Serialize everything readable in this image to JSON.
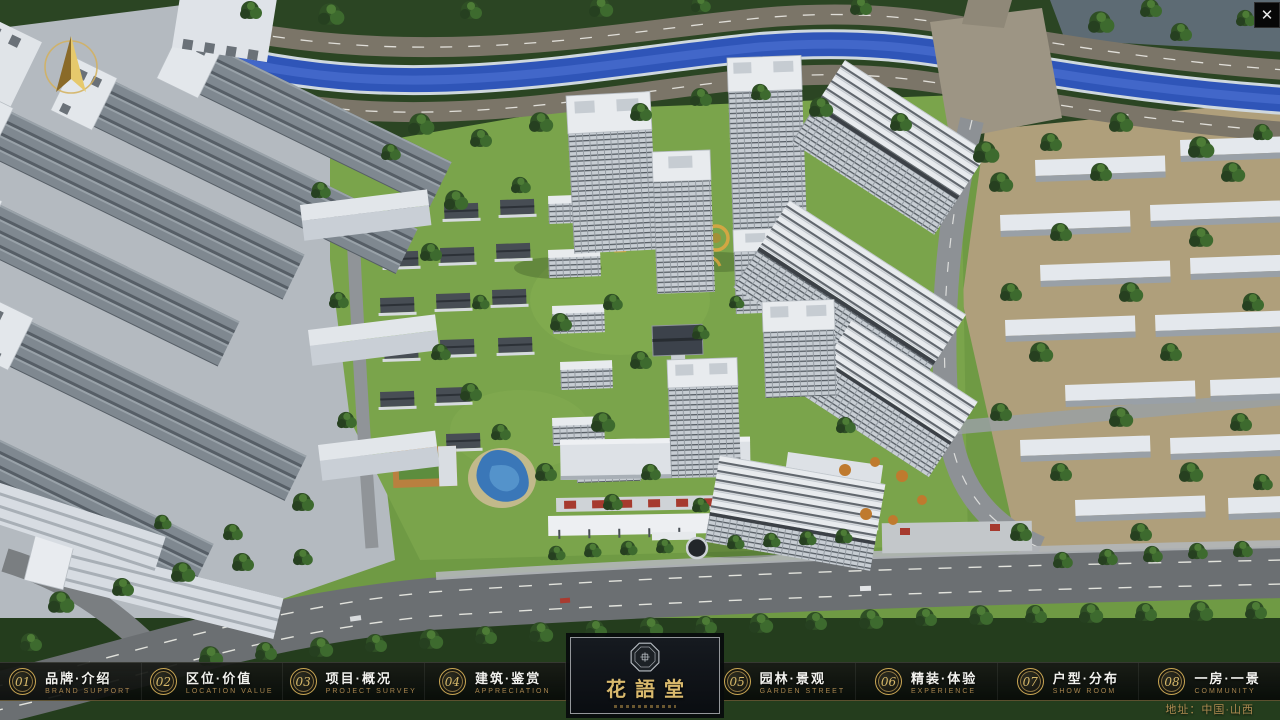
{
  "navbar": {
    "items": [
      {
        "num": "01",
        "zh": "品牌·介绍",
        "en": "BRAND SUPPORT"
      },
      {
        "num": "02",
        "zh": "区位·价值",
        "en": "LOCATION VALUE"
      },
      {
        "num": "03",
        "zh": "项目·概况",
        "en": "PROJECT SURVEY"
      },
      {
        "num": "04",
        "zh": "建筑·鉴赏",
        "en": "APPRECIATION"
      },
      {
        "num": "05",
        "zh": "园林·景观",
        "en": "GARDEN STREET"
      },
      {
        "num": "06",
        "zh": "精装·体验",
        "en": "EXPERIENCE"
      },
      {
        "num": "07",
        "zh": "户型·分布",
        "en": "SHOW ROOM"
      },
      {
        "num": "08",
        "zh": "一房·一景",
        "en": "COMMUNITY"
      }
    ]
  },
  "logo": {
    "title": "花語堂"
  },
  "footer": {
    "address": "地址：中国·山西"
  },
  "window": {
    "close_glyph": "✕"
  },
  "colors": {
    "gold": "#c9a653",
    "gold_text": "#d8b96a",
    "river": "#2f55b8",
    "lawn": "#76a047",
    "tree": "#2e4c24",
    "bar_bg": "#0a0c0a"
  }
}
